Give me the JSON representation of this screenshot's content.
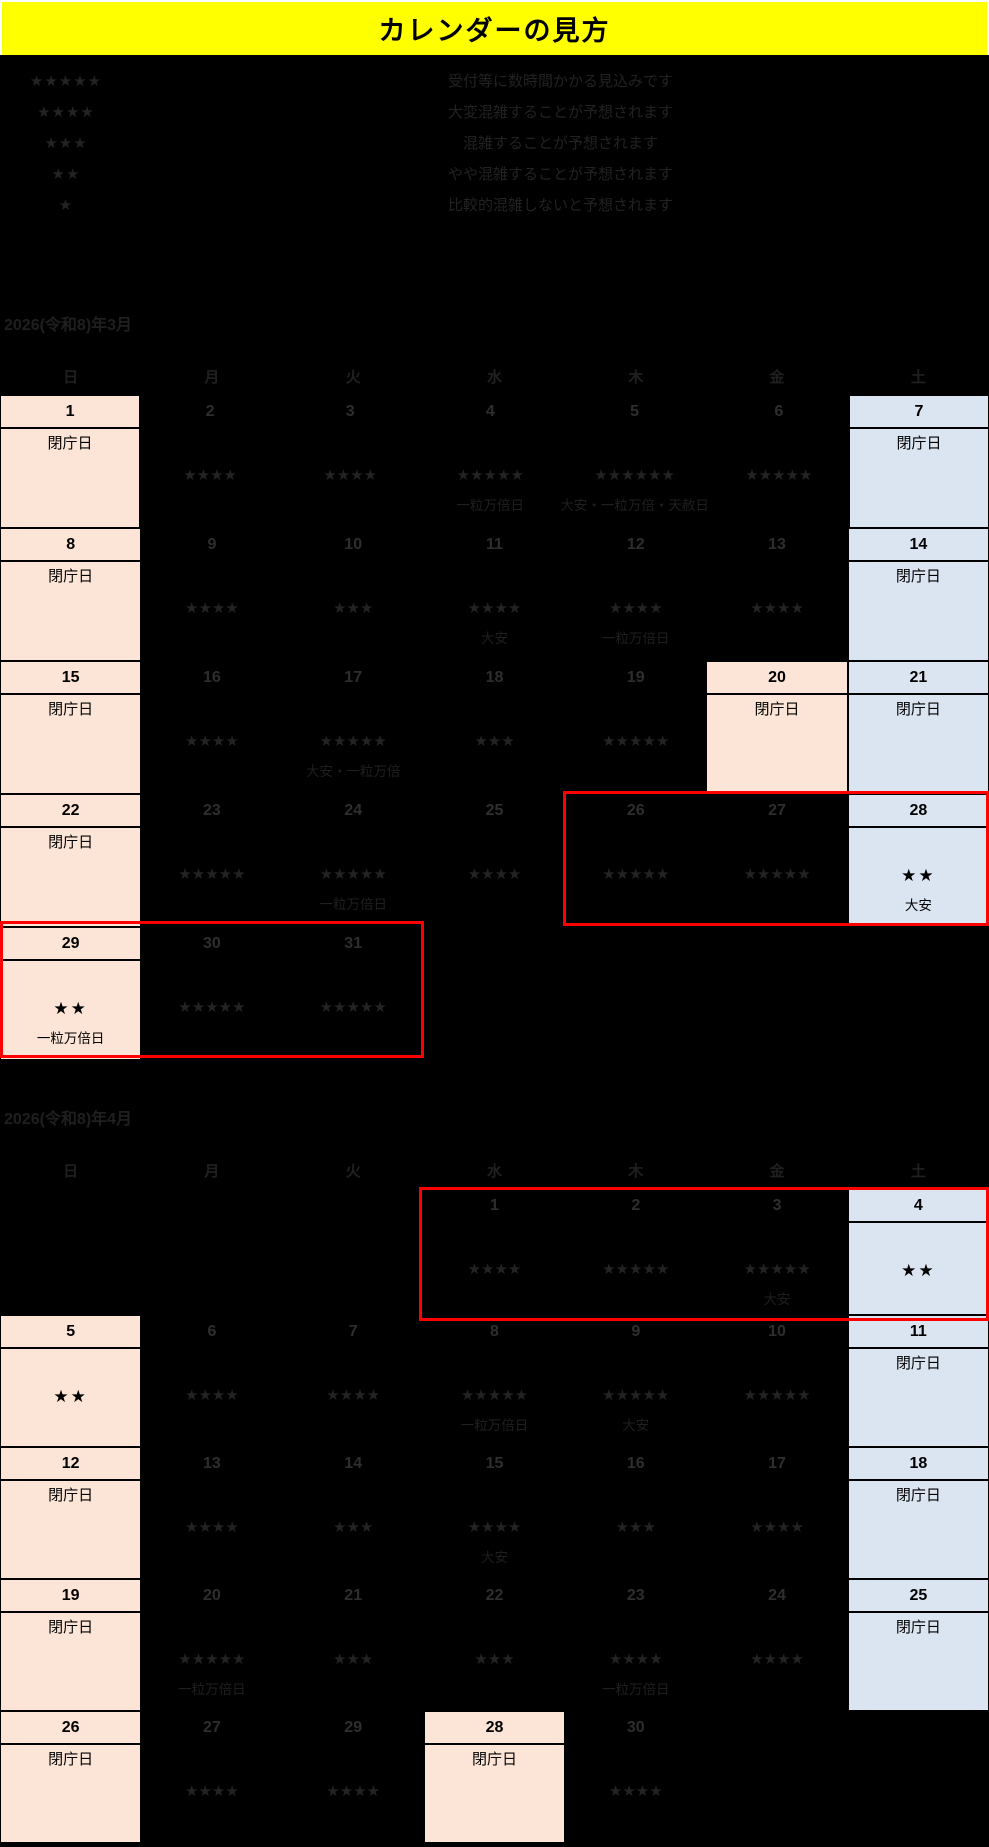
{
  "header": {
    "title": "カレンダーの見方"
  },
  "legend": {
    "items": [
      {
        "stars": 5,
        "desc": "受付等に数時間かかる見込みです"
      },
      {
        "stars": 4,
        "desc": "大変混雑することが予想されます"
      },
      {
        "stars": 3,
        "desc": "混雑することが予想されます"
      },
      {
        "stars": 2,
        "desc": "やや混雑することが予想されます"
      },
      {
        "stars": 1,
        "desc": "比較的混雑しないと予想されます"
      }
    ]
  },
  "labels": {
    "closed": "閉庁日"
  },
  "weekdays": [
    "日",
    "月",
    "火",
    "水",
    "木",
    "金",
    "土"
  ],
  "months": [
    {
      "title": "2026(令和8)年3月",
      "weeks": [
        [
          {
            "day": "1",
            "type": "sun",
            "closed": true
          },
          {
            "day": "2",
            "stars": 4
          },
          {
            "day": "3",
            "stars": 4
          },
          {
            "day": "4",
            "stars": 5,
            "note": "一粒万倍日"
          },
          {
            "day": "5",
            "stars": 6,
            "note": "大安・一粒万倍・天赦日"
          },
          {
            "day": "6",
            "stars": 5
          },
          {
            "day": "7",
            "type": "sat",
            "closed": true
          }
        ],
        [
          {
            "day": "8",
            "type": "sun",
            "closed": true
          },
          {
            "day": "9",
            "stars": 4
          },
          {
            "day": "10",
            "stars": 3
          },
          {
            "day": "11",
            "stars": 4,
            "note": "大安"
          },
          {
            "day": "12",
            "stars": 4,
            "note": "一粒万倍日"
          },
          {
            "day": "13",
            "stars": 4
          },
          {
            "day": "14",
            "type": "sat",
            "closed": true
          }
        ],
        [
          {
            "day": "15",
            "type": "sun",
            "closed": true
          },
          {
            "day": "16",
            "stars": 4
          },
          {
            "day": "17",
            "stars": 5,
            "note": "大安・一粒万倍"
          },
          {
            "day": "18",
            "stars": 3
          },
          {
            "day": "19",
            "stars": 5
          },
          {
            "day": "20",
            "type": "hol",
            "closed": true
          },
          {
            "day": "21",
            "type": "sat",
            "closed": true
          }
        ],
        [
          {
            "day": "22",
            "type": "sun",
            "closed": true
          },
          {
            "day": "23",
            "stars": 5
          },
          {
            "day": "24",
            "stars": 5,
            "note": "一粒万倍日"
          },
          {
            "day": "25",
            "stars": 4
          },
          {
            "day": "26",
            "stars": 5
          },
          {
            "day": "27",
            "stars": 5
          },
          {
            "day": "28",
            "type": "sat",
            "stars": 2,
            "solid": true,
            "note": "大安"
          }
        ],
        [
          {
            "day": "29",
            "type": "sun",
            "stars": 2,
            "solid": true,
            "note": "一粒万倍日"
          },
          {
            "day": "30",
            "stars": 5
          },
          {
            "day": "31",
            "stars": 5
          },
          {
            "type": "empty"
          },
          {
            "type": "empty"
          },
          {
            "type": "empty"
          },
          {
            "type": "empty"
          }
        ]
      ]
    },
    {
      "title": "2026(令和8)年4月",
      "weeks": [
        [
          {
            "type": "empty"
          },
          {
            "type": "empty"
          },
          {
            "type": "empty"
          },
          {
            "day": "1",
            "stars": 4
          },
          {
            "day": "2",
            "stars": 5
          },
          {
            "day": "3",
            "stars": 5,
            "note": "大安"
          },
          {
            "day": "4",
            "type": "sat",
            "stars": 2,
            "solid": true
          }
        ],
        [
          {
            "day": "5",
            "type": "sun",
            "stars": 2,
            "solid": true
          },
          {
            "day": "6",
            "stars": 4
          },
          {
            "day": "7",
            "stars": 4
          },
          {
            "day": "8",
            "stars": 5,
            "note": "一粒万倍日"
          },
          {
            "day": "9",
            "stars": 5,
            "note": "大安"
          },
          {
            "day": "10",
            "stars": 5
          },
          {
            "day": "11",
            "type": "sat",
            "closed": true
          }
        ],
        [
          {
            "day": "12",
            "type": "sun",
            "closed": true
          },
          {
            "day": "13",
            "stars": 4
          },
          {
            "day": "14",
            "stars": 3
          },
          {
            "day": "15",
            "stars": 4,
            "note": "大安"
          },
          {
            "day": "16",
            "stars": 3
          },
          {
            "day": "17",
            "stars": 4
          },
          {
            "day": "18",
            "type": "sat",
            "closed": true
          }
        ],
        [
          {
            "day": "19",
            "type": "sun",
            "closed": true
          },
          {
            "day": "20",
            "stars": 5,
            "note": "一粒万倍日"
          },
          {
            "day": "21",
            "stars": 3
          },
          {
            "day": "22",
            "stars": 3
          },
          {
            "day": "23",
            "stars": 4,
            "note": "一粒万倍日"
          },
          {
            "day": "24",
            "stars": 4
          },
          {
            "day": "25",
            "type": "sat",
            "closed": true
          }
        ],
        [
          {
            "day": "26",
            "type": "sun",
            "closed": true
          },
          {
            "day": "27",
            "stars": 4
          },
          {
            "day": "29",
            "stars": 4
          },
          {
            "day": "28",
            "type": "hol",
            "closed": true
          },
          {
            "day": "30",
            "stars": 4
          },
          {
            "type": "empty"
          },
          {
            "type": "empty"
          }
        ]
      ]
    }
  ],
  "colors": {
    "header_bg": "#FFFF00",
    "sunday_holiday_bg": "#FCE4D6",
    "saturday_bg": "#DBE5F1",
    "highlight_border": "#FF0000",
    "page_bg": "#000000"
  }
}
